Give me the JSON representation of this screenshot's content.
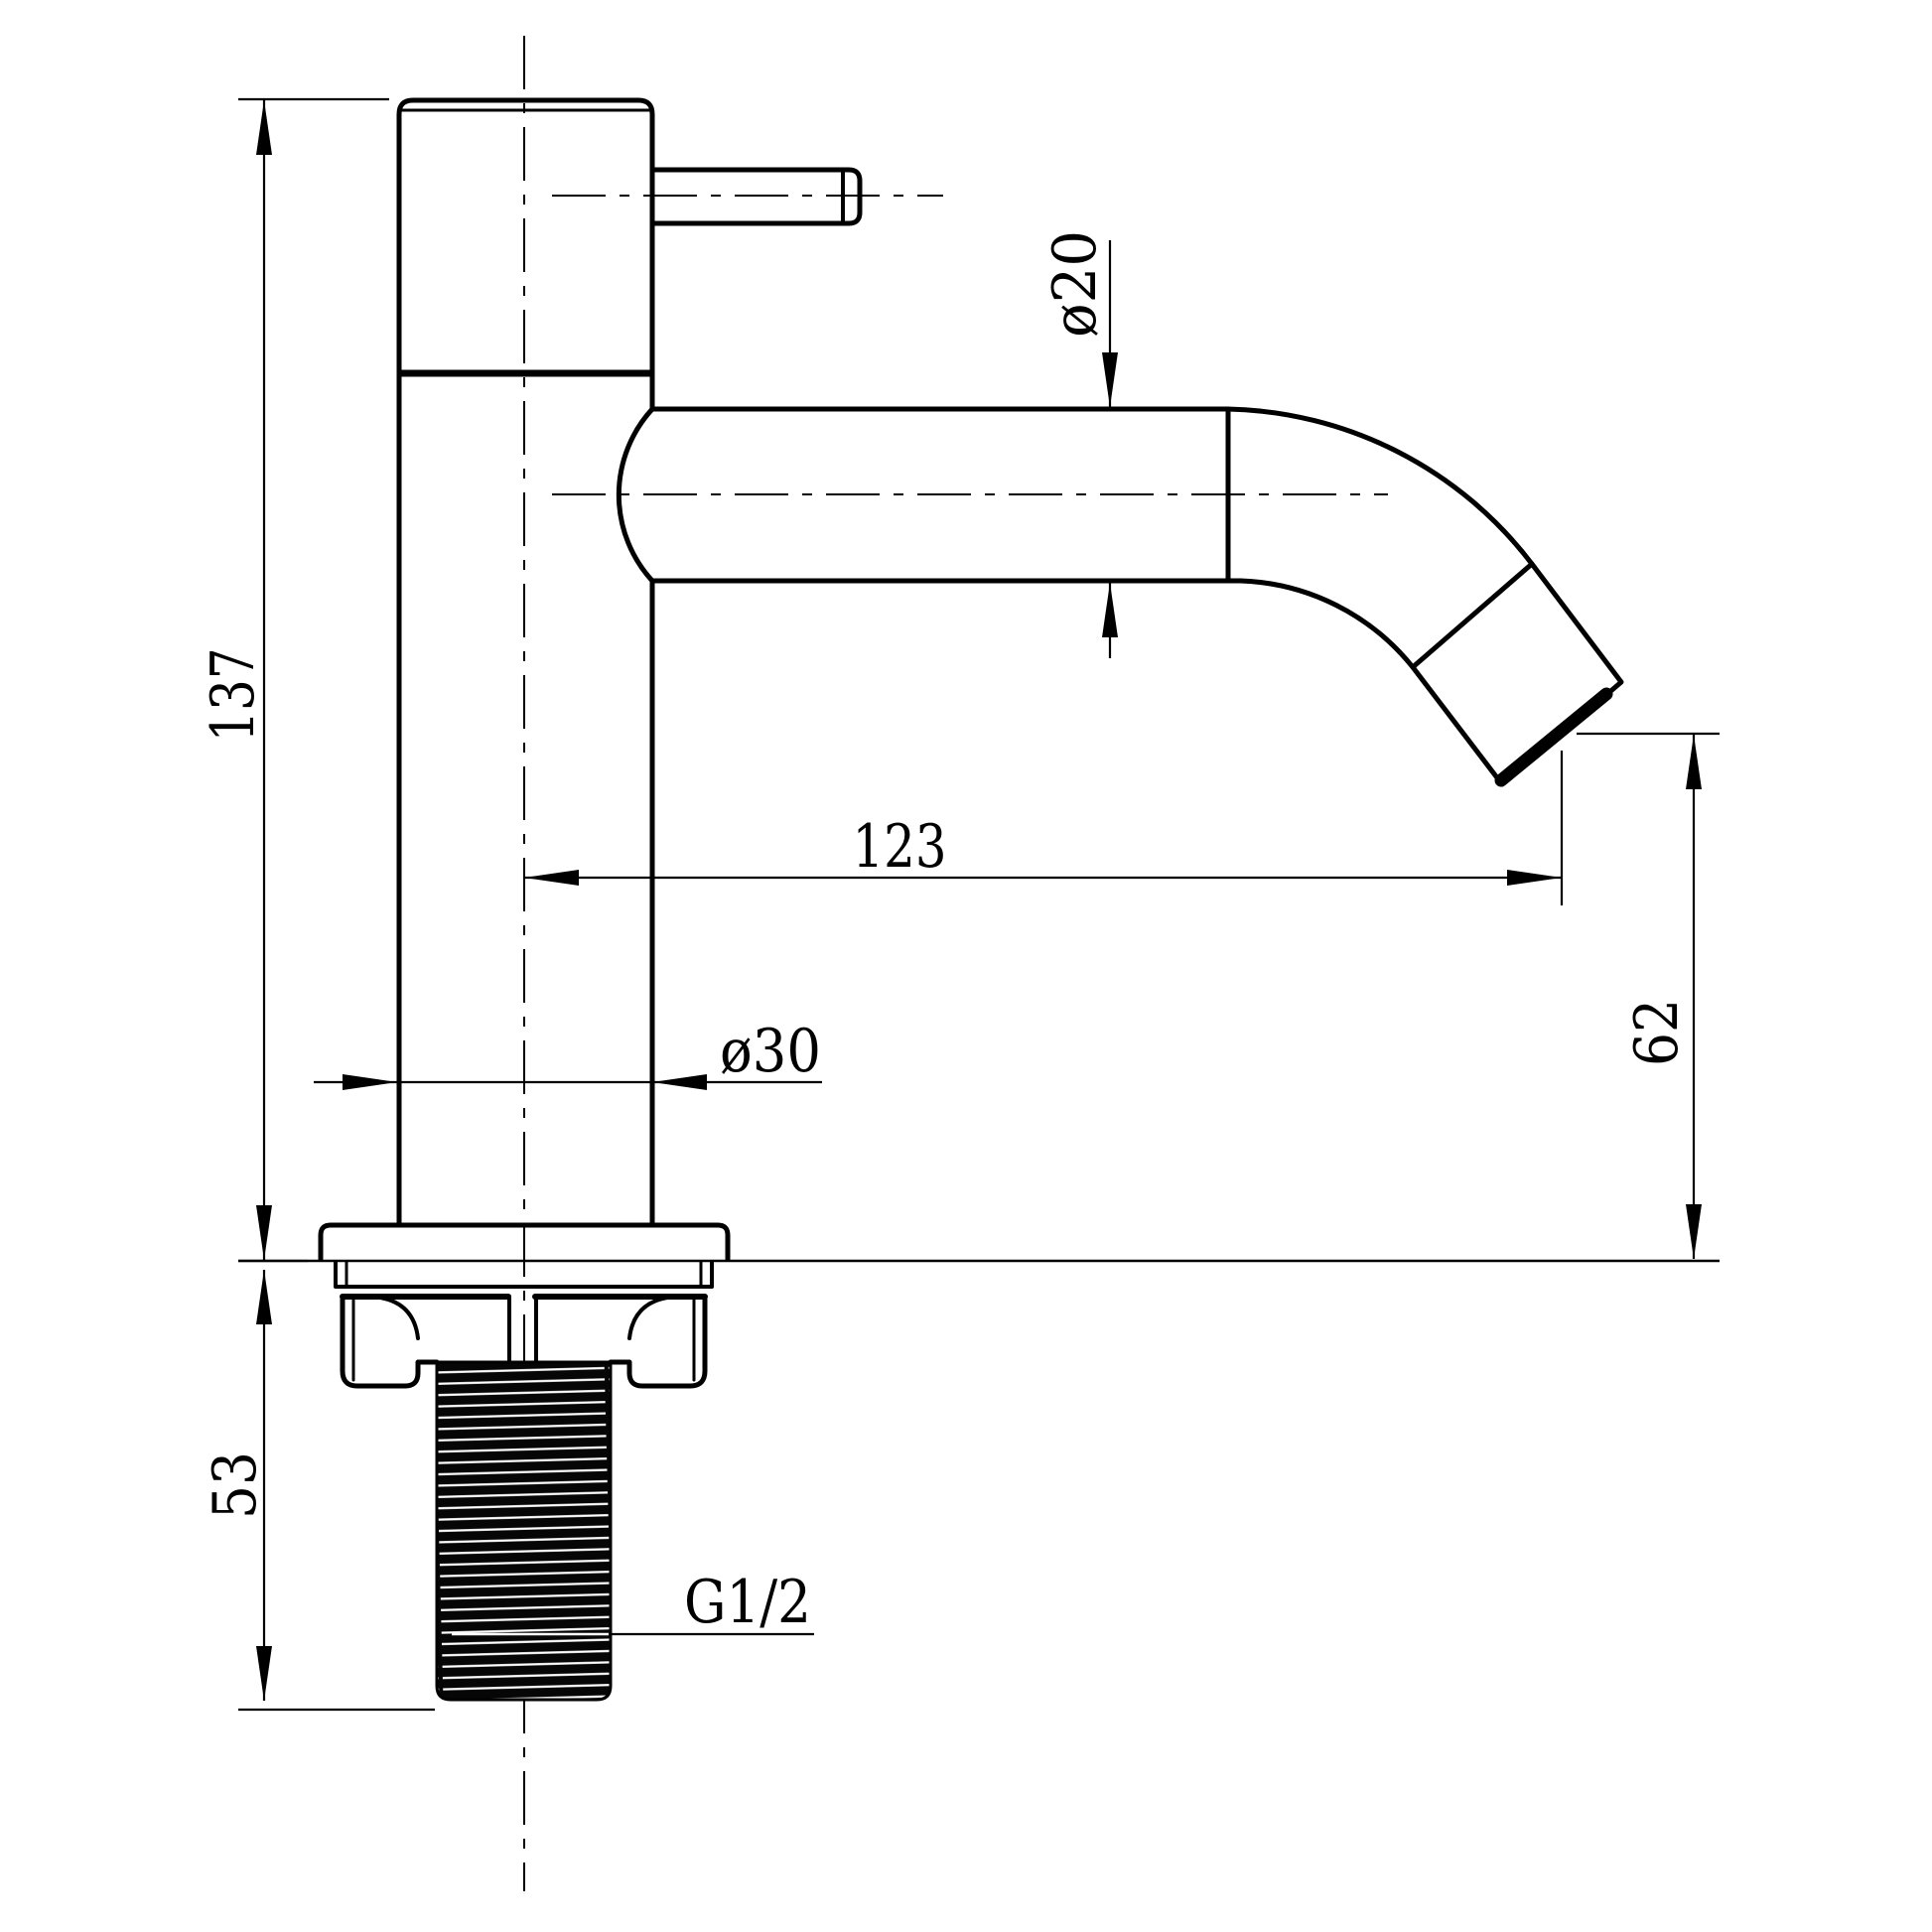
{
  "page": {
    "background": "#ffffff",
    "title": "Basin tap technical drawing, side elevation"
  },
  "drawing": {
    "units": "mm",
    "style": {
      "line_color": "#000000",
      "paper_color": "#ffffff",
      "thread_color": "#060606"
    },
    "labels": {
      "height_above_deck": "137",
      "tailpiece_length": "53",
      "spout_reach": "123",
      "outlet_height": "62",
      "spout_diameter": "ø20",
      "body_diameter": "ø30",
      "thread_spec": "G1/2"
    }
  }
}
